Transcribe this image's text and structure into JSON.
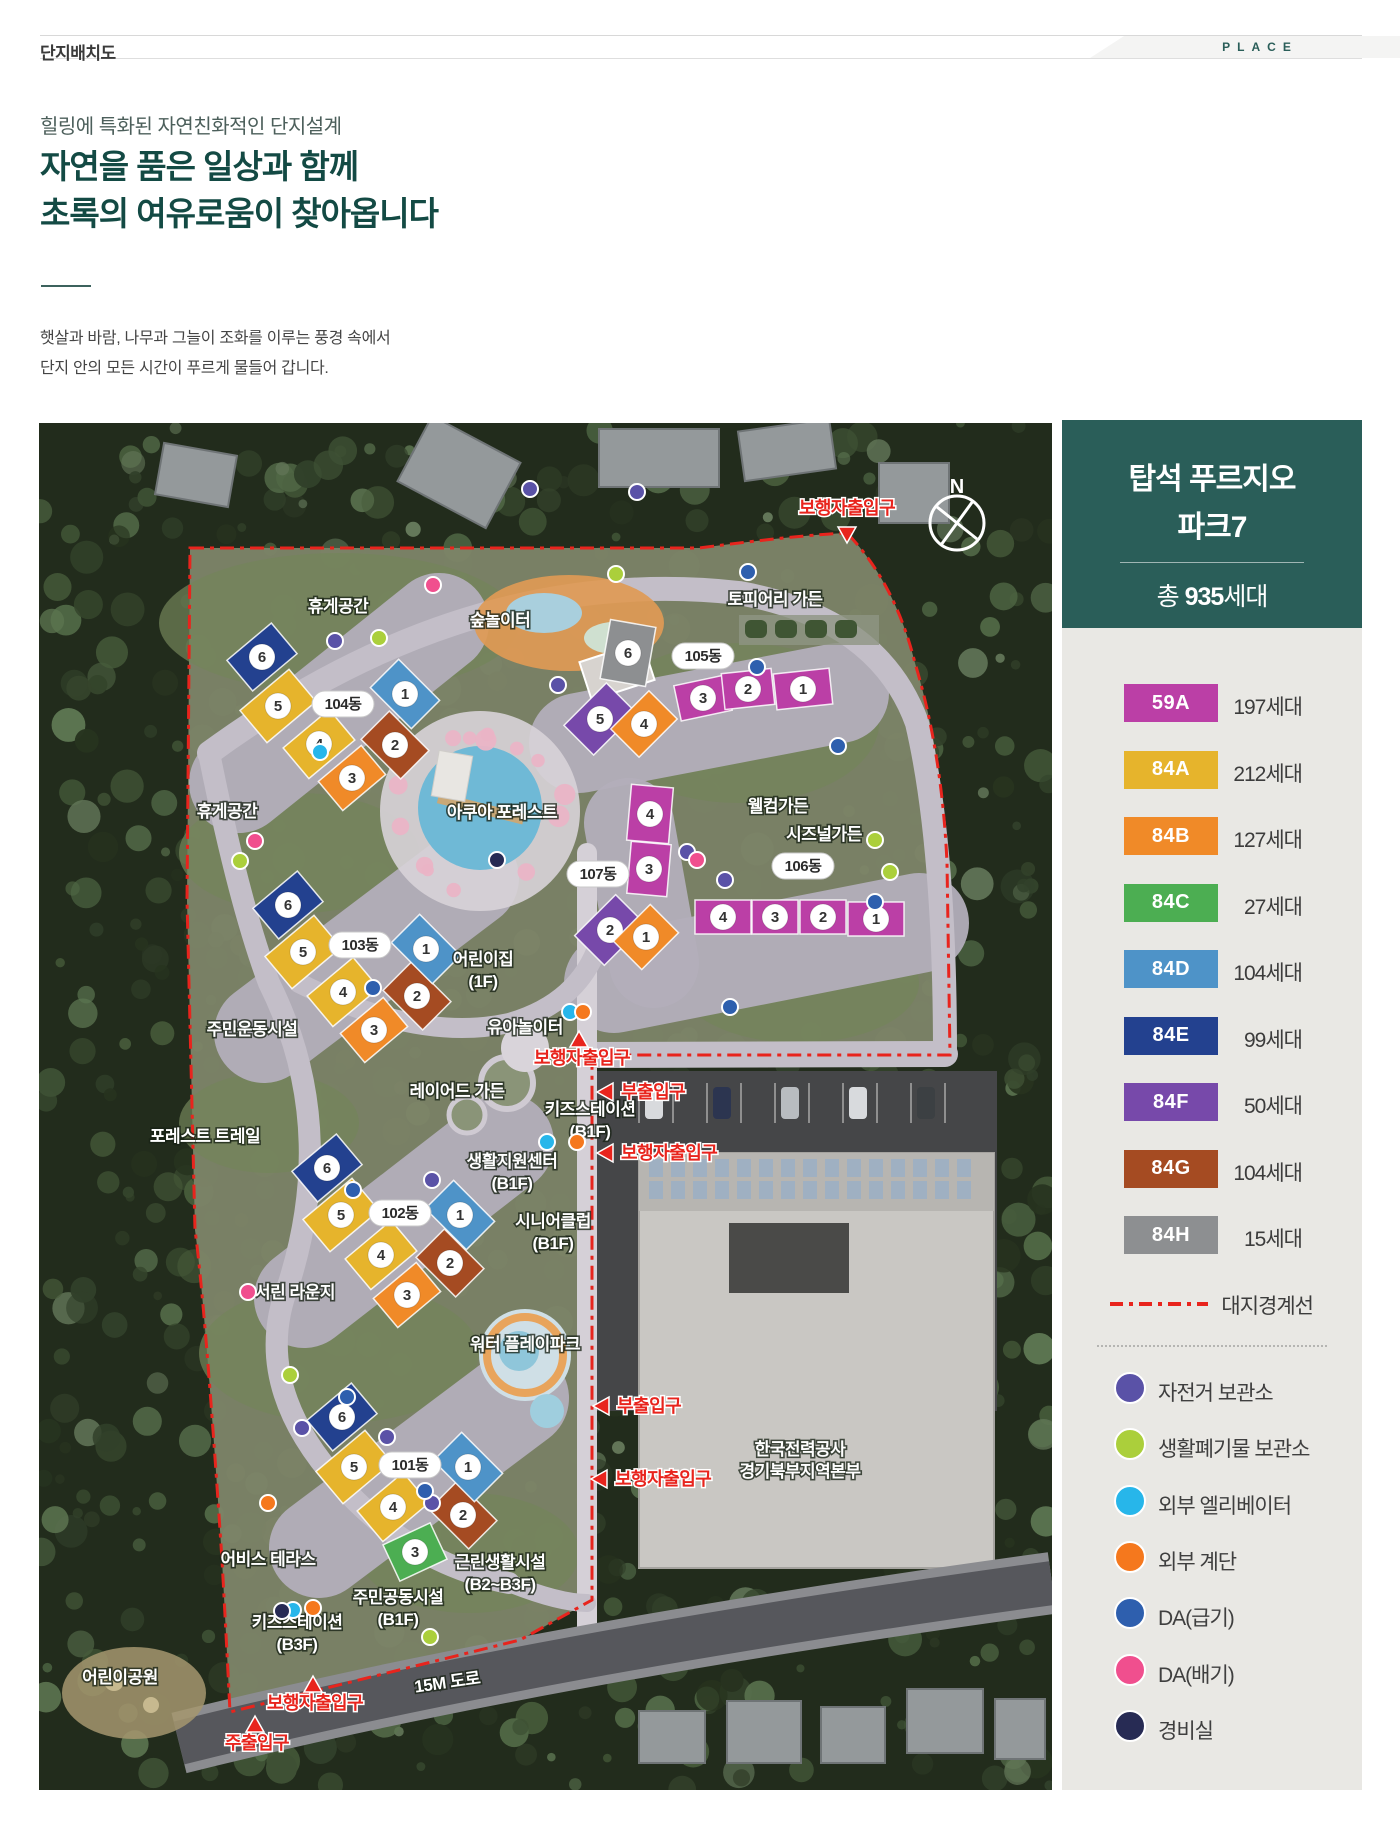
{
  "header": {
    "title": "단지배치도",
    "tag": "PLACE"
  },
  "intro": {
    "eyebrow": "힐링에 특화된 자연친화적인 단지설계",
    "title_line1": "자연을 품은 일상과 함께",
    "title_line2": "초록의 여유로움이 찾아옵니다",
    "body_line1": "햇살과 바람, 나무과 그늘이 조화를 이루는 풍경 속에서",
    "body_line2": "단지 안의 모든 시간이 푸르게 물들어 갑니다."
  },
  "panel": {
    "title_line1": "탑석 푸르지오",
    "title_line2": "파크7",
    "total_prefix": "총 ",
    "total_value": "935",
    "total_suffix": "세대"
  },
  "unit_types": [
    {
      "code": "59A",
      "households": "197세대",
      "color": "#bb3fa6"
    },
    {
      "code": "84A",
      "households": "212세대",
      "color": "#e6b42c"
    },
    {
      "code": "84B",
      "households": "127세대",
      "color": "#f08a28"
    },
    {
      "code": "84C",
      "households": "27세대",
      "color": "#4cae52"
    },
    {
      "code": "84D",
      "households": "104세대",
      "color": "#4e93c8"
    },
    {
      "code": "84E",
      "households": "99세대",
      "color": "#23418f"
    },
    {
      "code": "84F",
      "households": "50세대",
      "color": "#7749aa"
    },
    {
      "code": "84G",
      "households": "104세대",
      "color": "#a54b22"
    },
    {
      "code": "84H",
      "households": "15세대",
      "color": "#8d8f91"
    }
  ],
  "boundary_legend": {
    "label": "대지경계선",
    "color": "#e8241d"
  },
  "point_legend": [
    {
      "label": "자전거 보관소",
      "color": "#5a52a7"
    },
    {
      "label": "생활폐기물 보관소",
      "color": "#abcf3b"
    },
    {
      "label": "외부 엘리베이터",
      "color": "#27b6ea"
    },
    {
      "label": "외부 계단",
      "color": "#f5781d"
    },
    {
      "label": "DA(급기)",
      "color": "#2e5fae"
    },
    {
      "label": "DA(배기)",
      "color": "#f04f8e"
    },
    {
      "label": "경비실",
      "color": "#272b54"
    }
  ],
  "map": {
    "compass_label": "N",
    "road_label": "15M 도로",
    "buildings": [
      {
        "name": "104동",
        "nx": 304,
        "ny": 281,
        "blocks": [
          {
            "n": "6",
            "t": "84E",
            "x": 223,
            "y": 234,
            "r": -40,
            "w": 58,
            "h": 40
          },
          {
            "n": "5",
            "t": "84A",
            "x": 239,
            "y": 283,
            "r": -40,
            "w": 64,
            "h": 42
          },
          {
            "n": "4",
            "t": "84A",
            "x": 280,
            "y": 321,
            "r": -40,
            "w": 60,
            "h": 40
          },
          {
            "n": "3",
            "t": "84B",
            "x": 313,
            "y": 355,
            "r": -40,
            "w": 56,
            "h": 38
          },
          {
            "n": "2",
            "t": "84G",
            "x": 356,
            "y": 322,
            "r": 45,
            "w": 56,
            "h": 40
          },
          {
            "n": "1",
            "t": "84D",
            "x": 366,
            "y": 271,
            "r": 45,
            "w": 58,
            "h": 40
          }
        ]
      },
      {
        "name": "105동",
        "nx": 664,
        "ny": 233,
        "blocks": [
          {
            "n": "6",
            "t": "84H",
            "x": 589,
            "y": 230,
            "r": 10,
            "w": 46,
            "h": 60
          },
          {
            "n": "5",
            "t": "84F",
            "x": 561,
            "y": 296,
            "r": -45,
            "w": 60,
            "h": 42
          },
          {
            "n": "4",
            "t": "84B",
            "x": 605,
            "y": 301,
            "r": -45,
            "w": 54,
            "h": 40
          },
          {
            "n": "3",
            "t": "59A",
            "x": 664,
            "y": 275,
            "r": -12,
            "w": 52,
            "h": 36
          },
          {
            "n": "2",
            "t": "59A",
            "x": 709,
            "y": 266,
            "r": -6,
            "w": 50,
            "h": 36
          },
          {
            "n": "1",
            "t": "59A",
            "x": 764,
            "y": 266,
            "r": -6,
            "w": 56,
            "h": 36
          }
        ]
      },
      {
        "name": "103동",
        "nx": 321,
        "ny": 522,
        "blocks": [
          {
            "n": "6",
            "t": "84E",
            "x": 249,
            "y": 482,
            "r": -40,
            "w": 58,
            "h": 40
          },
          {
            "n": "5",
            "t": "84A",
            "x": 264,
            "y": 529,
            "r": -40,
            "w": 64,
            "h": 42
          },
          {
            "n": "4",
            "t": "84A",
            "x": 304,
            "y": 569,
            "r": -40,
            "w": 60,
            "h": 40
          },
          {
            "n": "3",
            "t": "84B",
            "x": 335,
            "y": 607,
            "r": -40,
            "w": 56,
            "h": 38
          },
          {
            "n": "2",
            "t": "84G",
            "x": 378,
            "y": 573,
            "r": 45,
            "w": 56,
            "h": 40
          },
          {
            "n": "1",
            "t": "84D",
            "x": 387,
            "y": 526,
            "r": 45,
            "w": 58,
            "h": 40
          }
        ]
      },
      {
        "name": "107동",
        "nx": 559,
        "ny": 451,
        "blocks": [
          {
            "n": "4",
            "t": "59A",
            "x": 611,
            "y": 391,
            "r": 5,
            "w": 42,
            "h": 56
          },
          {
            "n": "3",
            "t": "59A",
            "x": 610,
            "y": 446,
            "r": 5,
            "w": 40,
            "h": 52
          },
          {
            "n": "2",
            "t": "84F",
            "x": 571,
            "y": 507,
            "r": -45,
            "w": 58,
            "h": 42
          },
          {
            "n": "1",
            "t": "84B",
            "x": 607,
            "y": 514,
            "r": -45,
            "w": 52,
            "h": 40
          }
        ]
      },
      {
        "name": "106동",
        "nx": 764,
        "ny": 443,
        "blocks": [
          {
            "n": "4",
            "t": "59A",
            "x": 684,
            "y": 494,
            "r": 0,
            "w": 56,
            "h": 34
          },
          {
            "n": "3",
            "t": "59A",
            "x": 736,
            "y": 494,
            "r": 0,
            "w": 46,
            "h": 34
          },
          {
            "n": "2",
            "t": "59A",
            "x": 784,
            "y": 494,
            "r": 0,
            "w": 46,
            "h": 34
          },
          {
            "n": "1",
            "t": "59A",
            "x": 837,
            "y": 496,
            "r": 0,
            "w": 56,
            "h": 34
          }
        ]
      },
      {
        "name": "102동",
        "nx": 361,
        "ny": 790,
        "blocks": [
          {
            "n": "6",
            "t": "84E",
            "x": 288,
            "y": 745,
            "r": -40,
            "w": 58,
            "h": 40
          },
          {
            "n": "5",
            "t": "84A",
            "x": 302,
            "y": 792,
            "r": -40,
            "w": 64,
            "h": 42
          },
          {
            "n": "4",
            "t": "84A",
            "x": 342,
            "y": 832,
            "r": -40,
            "w": 60,
            "h": 40
          },
          {
            "n": "3",
            "t": "84B",
            "x": 368,
            "y": 872,
            "r": -40,
            "w": 56,
            "h": 38
          },
          {
            "n": "2",
            "t": "84G",
            "x": 411,
            "y": 840,
            "r": 45,
            "w": 56,
            "h": 40
          },
          {
            "n": "1",
            "t": "84D",
            "x": 421,
            "y": 792,
            "r": 45,
            "w": 58,
            "h": 40
          }
        ]
      },
      {
        "name": "101동",
        "nx": 371,
        "ny": 1042,
        "blocks": [
          {
            "n": "6",
            "t": "84E",
            "x": 303,
            "y": 994,
            "r": -40,
            "w": 58,
            "h": 40
          },
          {
            "n": "5",
            "t": "84A",
            "x": 315,
            "y": 1044,
            "r": -40,
            "w": 64,
            "h": 42
          },
          {
            "n": "4",
            "t": "84A",
            "x": 354,
            "y": 1084,
            "r": -40,
            "w": 60,
            "h": 40
          },
          {
            "n": "3",
            "t": "84C",
            "x": 376,
            "y": 1129,
            "r": -25,
            "w": 52,
            "h": 40
          },
          {
            "n": "2",
            "t": "84G",
            "x": 424,
            "y": 1092,
            "r": 45,
            "w": 56,
            "h": 40
          },
          {
            "n": "1",
            "t": "84D",
            "x": 429,
            "y": 1044,
            "r": 45,
            "w": 58,
            "h": 40
          }
        ]
      }
    ],
    "facilities": [
      {
        "lines": [
          "휴게공간"
        ],
        "x": 299,
        "y": 189
      },
      {
        "lines": [
          "숲놀이터"
        ],
        "x": 461,
        "y": 203
      },
      {
        "lines": [
          "토피어리 가든"
        ],
        "x": 736,
        "y": 182
      },
      {
        "lines": [
          "아쿠아 포레스트"
        ],
        "x": 463,
        "y": 395
      },
      {
        "lines": [
          "웰컴가든"
        ],
        "x": 739,
        "y": 389
      },
      {
        "lines": [
          "시즈널가든"
        ],
        "x": 785,
        "y": 417
      },
      {
        "lines": [
          "어린이집",
          "(1F)"
        ],
        "x": 444,
        "y": 542
      },
      {
        "lines": [
          "휴게공간"
        ],
        "x": 188,
        "y": 394
      },
      {
        "lines": [
          "주민운동시설"
        ],
        "x": 213,
        "y": 612
      },
      {
        "lines": [
          "유아놀이터"
        ],
        "x": 486,
        "y": 610
      },
      {
        "lines": [
          "레이어드 가든"
        ],
        "x": 418,
        "y": 674
      },
      {
        "lines": [
          "키즈스테이션",
          "(B1F)"
        ],
        "x": 551,
        "y": 692
      },
      {
        "lines": [
          "포레스트 트레일"
        ],
        "x": 166,
        "y": 719
      },
      {
        "lines": [
          "생활지원센터",
          "(B1F)"
        ],
        "x": 473,
        "y": 744
      },
      {
        "lines": [
          "시니어클럽",
          "(B1F)"
        ],
        "x": 514,
        "y": 804
      },
      {
        "lines": [
          "서린 라운지"
        ],
        "x": 256,
        "y": 875
      },
      {
        "lines": [
          "워터 플레이파크"
        ],
        "x": 486,
        "y": 927
      },
      {
        "lines": [
          "한국전력공사",
          "경기북부지역본부"
        ],
        "x": 761,
        "y": 1032
      },
      {
        "lines": [
          "어비스 테라스"
        ],
        "x": 229,
        "y": 1142
      },
      {
        "lines": [
          "근린생활시설",
          "(B2~B3F)"
        ],
        "x": 461,
        "y": 1145
      },
      {
        "lines": [
          "주민공동시설",
          "(B1F)"
        ],
        "x": 359,
        "y": 1180
      },
      {
        "lines": [
          "키즈스테이션",
          "(B3F)"
        ],
        "x": 258,
        "y": 1205
      },
      {
        "lines": [
          "어린이공원"
        ],
        "x": 81,
        "y": 1260
      },
      {
        "lines": [
          "15M 도로"
        ],
        "x": 409,
        "y": 1265,
        "rot": -8
      }
    ],
    "entrances": [
      {
        "label": "보행자출입구",
        "tx": 808,
        "ty": 91,
        "anchor": "middle",
        "arrow": "down",
        "ax": 808,
        "ay": 112
      },
      {
        "label": "보행자출입구",
        "tx": 543,
        "ty": 641,
        "anchor": "middle",
        "arrow": "up",
        "ax": 540,
        "ay": 616
      },
      {
        "label": "부출입구",
        "tx": 582,
        "ty": 675,
        "anchor": "start",
        "arrow": "left",
        "ax": 566,
        "ay": 669
      },
      {
        "label": "보행자출입구",
        "tx": 582,
        "ty": 736,
        "anchor": "start",
        "arrow": "left",
        "ax": 566,
        "ay": 730
      },
      {
        "label": "부출입구",
        "tx": 578,
        "ty": 989,
        "anchor": "start",
        "arrow": "left",
        "ax": 562,
        "ay": 983
      },
      {
        "label": "보행자출입구",
        "tx": 576,
        "ty": 1062,
        "anchor": "start",
        "arrow": "left",
        "ax": 560,
        "ay": 1056
      },
      {
        "label": "보행자출입구",
        "tx": 276,
        "ty": 1286,
        "anchor": "middle",
        "arrow": "up",
        "ax": 274,
        "ay": 1261
      },
      {
        "label": "주출입구",
        "tx": 218,
        "ty": 1326,
        "anchor": "middle",
        "arrow": "up",
        "ax": 216,
        "ay": 1301
      }
    ],
    "dots": [
      {
        "t": 0,
        "x": 296,
        "y": 218
      },
      {
        "t": 0,
        "x": 519,
        "y": 262
      },
      {
        "t": 0,
        "x": 491,
        "y": 66
      },
      {
        "t": 0,
        "x": 598,
        "y": 69
      },
      {
        "t": 0,
        "x": 648,
        "y": 429
      },
      {
        "t": 0,
        "x": 686,
        "y": 457
      },
      {
        "t": 0,
        "x": 393,
        "y": 757
      },
      {
        "t": 0,
        "x": 263,
        "y": 1005
      },
      {
        "t": 0,
        "x": 348,
        "y": 1014
      },
      {
        "t": 0,
        "x": 393,
        "y": 1080
      },
      {
        "t": 1,
        "x": 577,
        "y": 151
      },
      {
        "t": 1,
        "x": 340,
        "y": 215
      },
      {
        "t": 1,
        "x": 201,
        "y": 438
      },
      {
        "t": 1,
        "x": 836,
        "y": 417
      },
      {
        "t": 1,
        "x": 851,
        "y": 449
      },
      {
        "t": 1,
        "x": 251,
        "y": 952
      },
      {
        "t": 1,
        "x": 391,
        "y": 1214
      },
      {
        "t": 2,
        "x": 531,
        "y": 589
      },
      {
        "t": 2,
        "x": 508,
        "y": 719
      },
      {
        "t": 2,
        "x": 254,
        "y": 1187
      },
      {
        "t": 2,
        "x": 281,
        "y": 329
      },
      {
        "t": 3,
        "x": 544,
        "y": 589
      },
      {
        "t": 3,
        "x": 538,
        "y": 719
      },
      {
        "t": 3,
        "x": 274,
        "y": 1185
      },
      {
        "t": 3,
        "x": 229,
        "y": 1080
      },
      {
        "t": 4,
        "x": 709,
        "y": 149
      },
      {
        "t": 4,
        "x": 718,
        "y": 244
      },
      {
        "t": 4,
        "x": 799,
        "y": 323
      },
      {
        "t": 4,
        "x": 836,
        "y": 479
      },
      {
        "t": 4,
        "x": 691,
        "y": 584
      },
      {
        "t": 4,
        "x": 334,
        "y": 565
      },
      {
        "t": 4,
        "x": 314,
        "y": 767
      },
      {
        "t": 4,
        "x": 308,
        "y": 974
      },
      {
        "t": 4,
        "x": 386,
        "y": 1068
      },
      {
        "t": 5,
        "x": 394,
        "y": 162
      },
      {
        "t": 5,
        "x": 216,
        "y": 418
      },
      {
        "t": 5,
        "x": 209,
        "y": 869
      },
      {
        "t": 5,
        "x": 658,
        "y": 437
      },
      {
        "t": 6,
        "x": 243,
        "y": 1188
      },
      {
        "t": 6,
        "x": 458,
        "y": 437
      }
    ]
  }
}
